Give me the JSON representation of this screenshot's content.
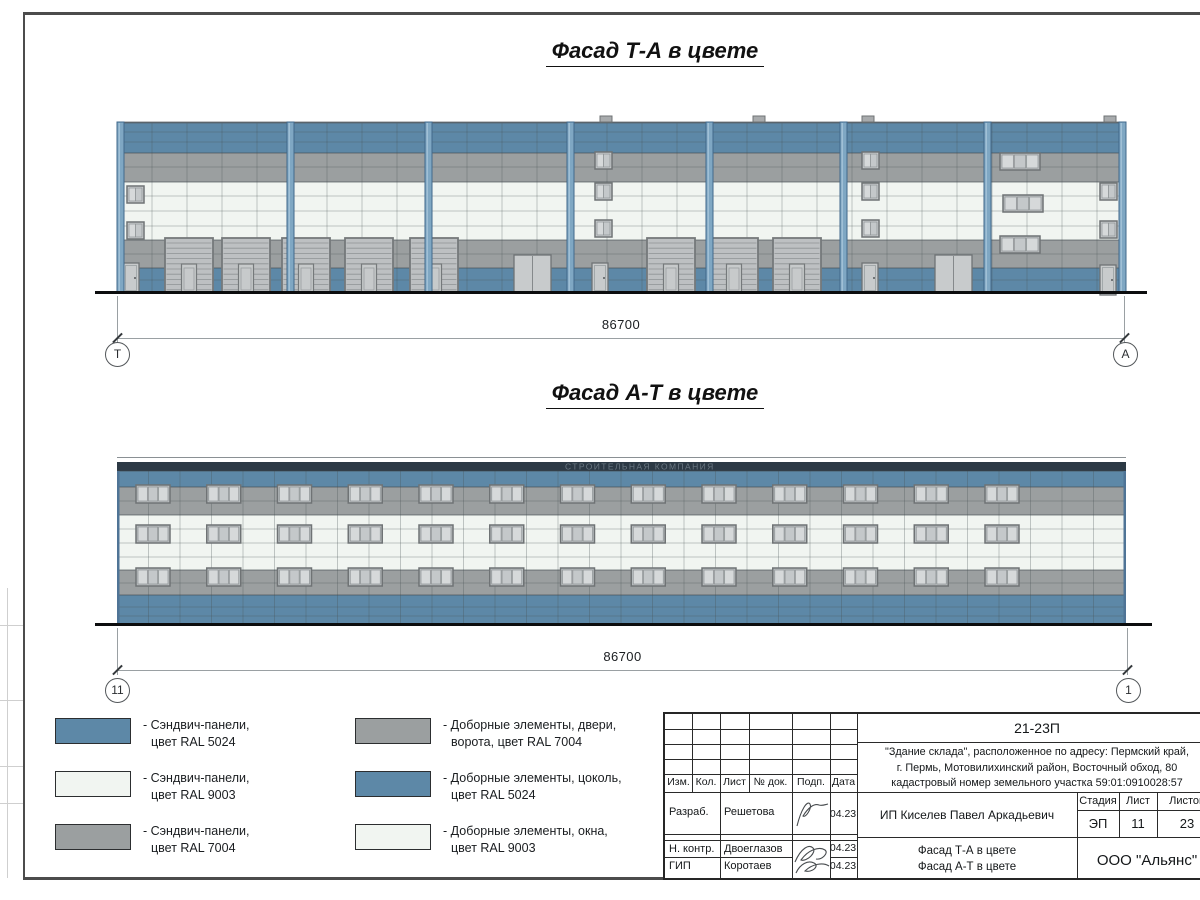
{
  "palette": {
    "blue": "#5d88a7",
    "white": "#f1f5f1",
    "gray": "#9b9fa0",
    "parapet": "#2c3945",
    "pilaster_fill": "#7fa7c3",
    "pilaster_edge": "#41688b",
    "pilaster_hl": "#a9c6da",
    "gate_fill": "#bdc0c2",
    "gate_edge": "#75797b",
    "door_fill": "#c8cbcc",
    "door_edge": "#6f7375",
    "window_fill": "#c9cdcf",
    "window_edge": "#6f7375",
    "pane_light": "#d6d9da",
    "pane_dark": "#c4c8ca",
    "edge_strip": "#4f7496",
    "joint": "rgba(70,78,84,0.30)",
    "band_edge": "rgba(66,73,78,0.65)"
  },
  "titles": {
    "facade_ta": "Фасад Т-А в цвете",
    "facade_at": "Фасад А-Т в цвете"
  },
  "dim_ta": {
    "value": "86700",
    "left_axis": "Т",
    "right_axis": "А"
  },
  "dim_at": {
    "value": "86700",
    "left_axis": "11",
    "right_axis": "1"
  },
  "watermark": "СТРОИТЕЛЬНАЯ КОМПАНИЯ",
  "legend": {
    "col1": [
      {
        "color": "#5d88a7",
        "lines": [
          "- Сэндвич-панели,",
          "цвет RAL 5024"
        ]
      },
      {
        "color": "#f1f5f1",
        "lines": [
          "- Сэндвич-панели,",
          "цвет RAL 9003"
        ]
      },
      {
        "color": "#9b9fa0",
        "lines": [
          "- Сэндвич-панели,",
          "цвет RAL 7004"
        ]
      }
    ],
    "col2": [
      {
        "color": "#9b9fa0",
        "lines": [
          "- Доборные элементы, двери,",
          "ворота, цвет RAL 7004"
        ]
      },
      {
        "color": "#5d88a7",
        "lines": [
          "- Доборные элементы, цоколь,",
          "цвет RAL 5024"
        ]
      },
      {
        "color": "#f1f5f1",
        "lines": [
          "- Доборные элементы, окна,",
          "цвет RAL 9003"
        ]
      }
    ]
  },
  "stamp": {
    "doc_number": "21-23П",
    "address_lines": [
      "\"Здание склада\", расположенное по адресу: Пермский край,",
      "г. Пермь, Мотовилихинский район, Восточный обход, 80",
      "кадастровый номер земельного участка 59:01:0910028:57"
    ],
    "header_cols": [
      "Изм.",
      "Кол.",
      "Лист",
      "№ док.",
      "Подп.",
      "Дата"
    ],
    "sign_rows": [
      {
        "role": "Разраб.",
        "name": "Решетова",
        "date": "04.23"
      },
      {
        "role": "Н. контр.",
        "name": "Двоеглазов",
        "date": "04.23"
      },
      {
        "role": "ГИП",
        "name": "Коротаев",
        "date": "04.23"
      }
    ],
    "client": "ИП Киселев Павел Аркадьевич",
    "stage_label": "Стадия",
    "sheet_label": "Лист",
    "sheets_label": "Листов",
    "stage": "ЭП",
    "sheet_no": "11",
    "sheets_total": "23",
    "drawing_titles": [
      "Фасад Т-А в цвете",
      "Фасад А-Т в цвете"
    ],
    "organization": "ООО \"Альянс\""
  },
  "facade_ta": {
    "w": 1009,
    "h": 171,
    "bands": [
      {
        "y": 0,
        "h": 31,
        "color": "blue",
        "joints": [
          10,
          20
        ]
      },
      {
        "y": 31,
        "h": 29,
        "color": "gray",
        "joints": [
          45
        ]
      },
      {
        "y": 60,
        "h": 58,
        "color": "white",
        "joints": [
          74,
          89,
          104
        ]
      },
      {
        "y": 118,
        "h": 28,
        "color": "gray",
        "joints": [
          132
        ]
      },
      {
        "y": 146,
        "h": 25,
        "color": "blue",
        "joints": [
          158
        ]
      }
    ],
    "vjoint_step": 35,
    "pilasters": [
      0,
      170,
      308,
      450,
      589,
      723,
      867,
      1002
    ],
    "gates": [
      48,
      105,
      165,
      228,
      293,
      530,
      593,
      656
    ],
    "gate": {
      "y": 116,
      "w": 48,
      "h": 55
    },
    "doors": [
      [
        6,
        141
      ],
      [
        475,
        141
      ],
      [
        745,
        141
      ],
      [
        983,
        143
      ]
    ],
    "door": {
      "w": 16,
      "h": 30
    },
    "double_doors": [
      [
        397,
        133
      ],
      [
        818,
        133
      ]
    ],
    "double_door": {
      "w": 37,
      "h": 38
    },
    "windows_small": [
      [
        10,
        64
      ],
      [
        10,
        100
      ],
      [
        478,
        30
      ],
      [
        478,
        61
      ],
      [
        478,
        98
      ],
      [
        745,
        30
      ],
      [
        745,
        61
      ],
      [
        745,
        98
      ],
      [
        983,
        61
      ],
      [
        983,
        99
      ]
    ],
    "window_small": {
      "w": 17,
      "h": 17
    },
    "windows_triple": [
      [
        883,
        31
      ],
      [
        886,
        73
      ],
      [
        883,
        114
      ]
    ],
    "window_triple": {
      "w": 40,
      "h": 17
    },
    "vents": [
      483,
      636,
      745,
      987
    ]
  },
  "facade_at": {
    "w": 1009,
    "h": 170,
    "roofline": true,
    "parapet": {
      "y": 7,
      "h": 9
    },
    "bands": [
      {
        "y": 16,
        "h": 16,
        "color": "blue",
        "joints": []
      },
      {
        "y": 32,
        "h": 28,
        "color": "gray",
        "joints": [
          46
        ]
      },
      {
        "y": 60,
        "h": 55,
        "color": "white",
        "joints": [
          74,
          88,
          102
        ]
      },
      {
        "y": 115,
        "h": 25,
        "color": "gray",
        "joints": [
          128
        ]
      },
      {
        "y": 140,
        "h": 30,
        "color": "blue",
        "joints": [
          152,
          161
        ]
      }
    ],
    "vjoint_step": 31.5,
    "window_rows": [
      30,
      70,
      113
    ],
    "window_cols": {
      "start": 19,
      "step": 70.75,
      "count": 13
    },
    "window": {
      "w": 34,
      "h": 18
    },
    "edges": true
  }
}
